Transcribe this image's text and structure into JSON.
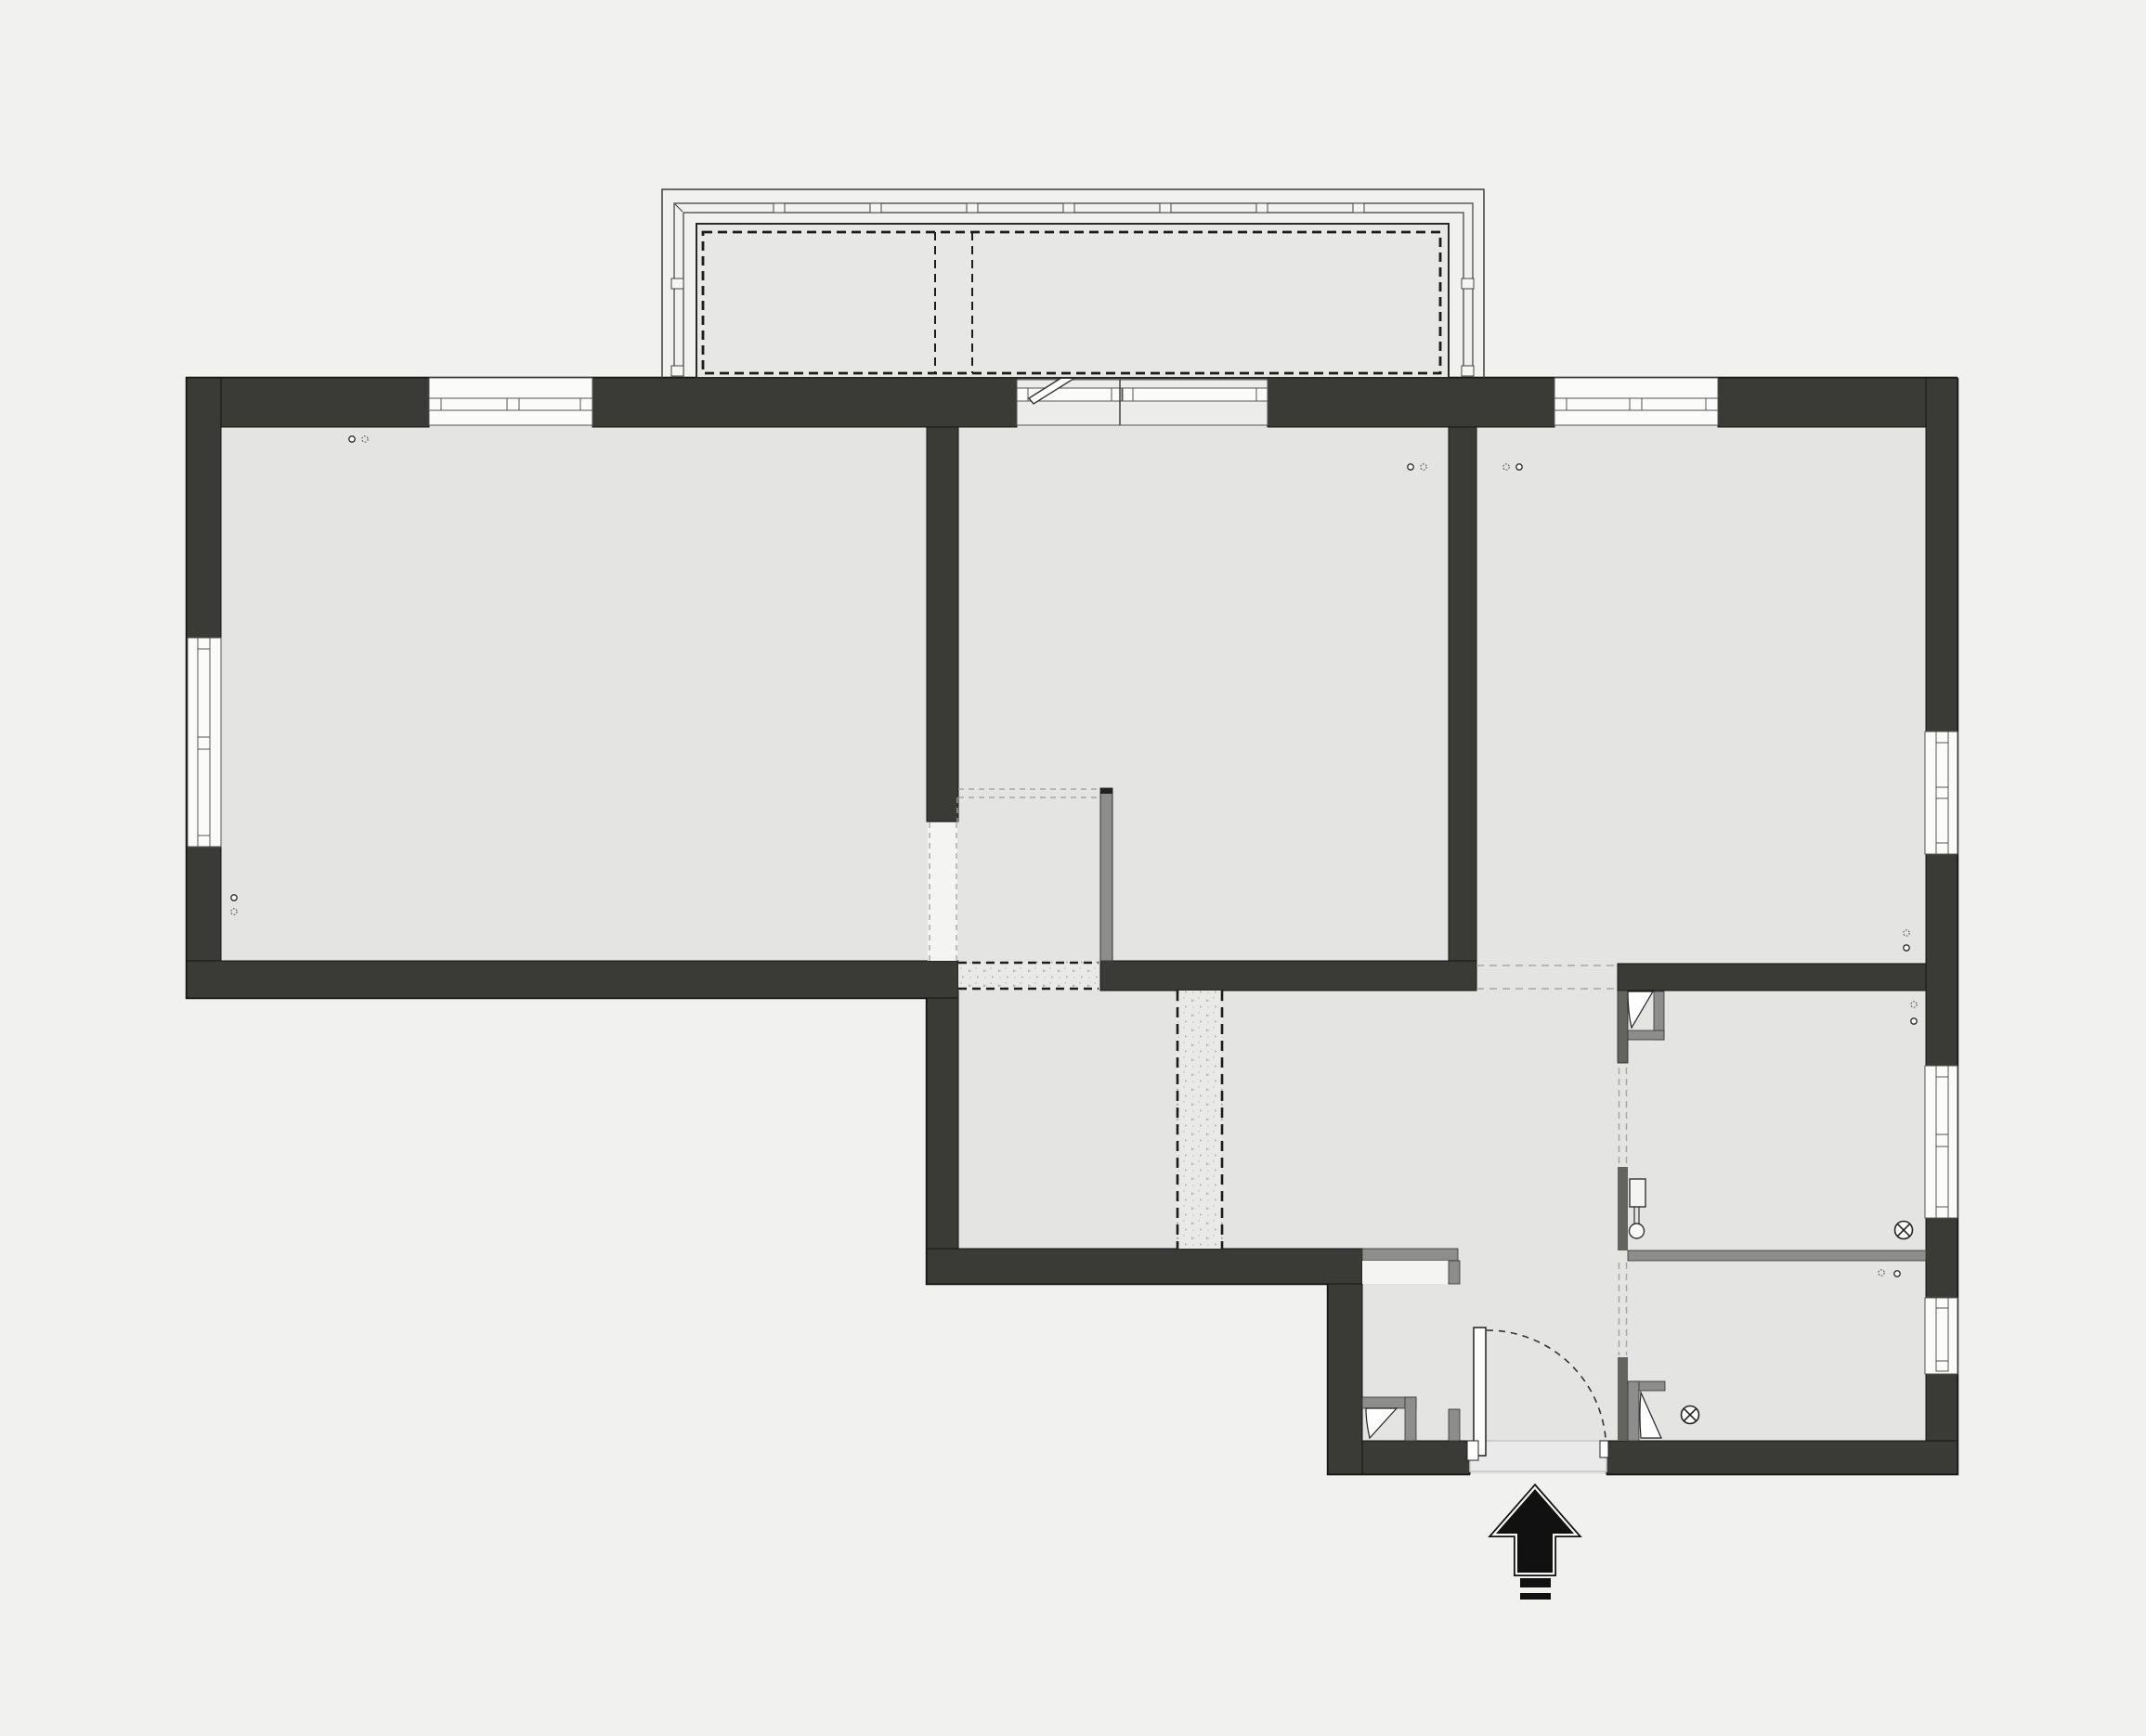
{
  "plan": {
    "kind": "architectural-floor-plan",
    "view": "top-down",
    "visible_text": "",
    "zones": [
      "living-room",
      "middle-room",
      "right-room",
      "nook",
      "hallway",
      "vestibule",
      "bathroom",
      "wc",
      "balcony"
    ],
    "counts": {
      "windows": 7,
      "balcony_door_units": 1,
      "interior_doors": 4,
      "entrance_doors": 1,
      "ceiling_lights": 2,
      "outlet_pairs": 7,
      "demolition_hatch_strips": 2
    }
  },
  "palette": {
    "bg": "#f1f1f0",
    "floor": "#e4e4e3",
    "wall": "#3a3a37",
    "wallStroke": "#141414",
    "gray": "#8d8d8b",
    "grayDark": "#64645f",
    "white": "#fbfbfa",
    "lineGray": "#a6a6a4",
    "speckBg": "#e9e9e8",
    "ink": "#1c1c1b"
  },
  "symbols": [
    {
      "name": "entrance-arrow-icon",
      "meaning": "main entry direction"
    },
    {
      "name": "door-swing-icon",
      "meaning": "door leaf with swing arc"
    },
    {
      "name": "tilt-window-leaf-icon",
      "meaning": "balcony door leaf shown tilted open"
    },
    {
      "name": "ceiling-light-icon",
      "meaning": "crossed circle lamp symbol"
    },
    {
      "name": "outlet-icon",
      "meaning": "small circle pair, one solid one dashed"
    },
    {
      "name": "radiator-valve-icon",
      "meaning": "small rectangle with stem and circle"
    },
    {
      "name": "demolition-hatch-icon",
      "meaning": "dashed strip with speckle fill"
    }
  ]
}
